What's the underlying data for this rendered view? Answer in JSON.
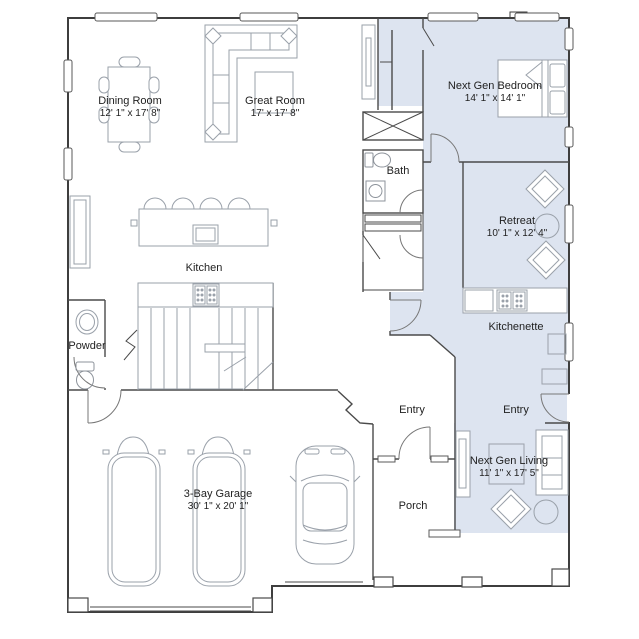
{
  "plan": {
    "type": "residential-floor-plan",
    "colors": {
      "background": "#ffffff",
      "next_gen_suite_fill": "#dde4f0",
      "wall": "#3e3e3e",
      "interior_wall": "#4a4a4a",
      "furniture_line": "#9aa1aa",
      "label_text": "#1f1f1f"
    },
    "rooms": [
      {
        "name": "Dining Room",
        "dims": "12' 1\" x 17' 8\""
      },
      {
        "name": "Great Room",
        "dims": "17' x 17' 8\""
      },
      {
        "name": "Kitchen",
        "dims": ""
      },
      {
        "name": "Powder",
        "dims": ""
      },
      {
        "name": "3-Bay Garage",
        "dims": "30' 1\" x 20' 1\""
      },
      {
        "name": "Entry",
        "dims": ""
      },
      {
        "name": "Porch",
        "dims": ""
      },
      {
        "name": "Bath",
        "dims": ""
      },
      {
        "name": "Next Gen Bedroom",
        "dims": "14' 1\" x 14' 1\""
      },
      {
        "name": "Retreat",
        "dims": "10' 1\" x 12' 4\""
      },
      {
        "name": "Kitchenette",
        "dims": ""
      },
      {
        "name": "Entry",
        "dims": ""
      },
      {
        "name": "Next Gen Living",
        "dims": "11' 1\" x 17' 5\""
      }
    ]
  }
}
